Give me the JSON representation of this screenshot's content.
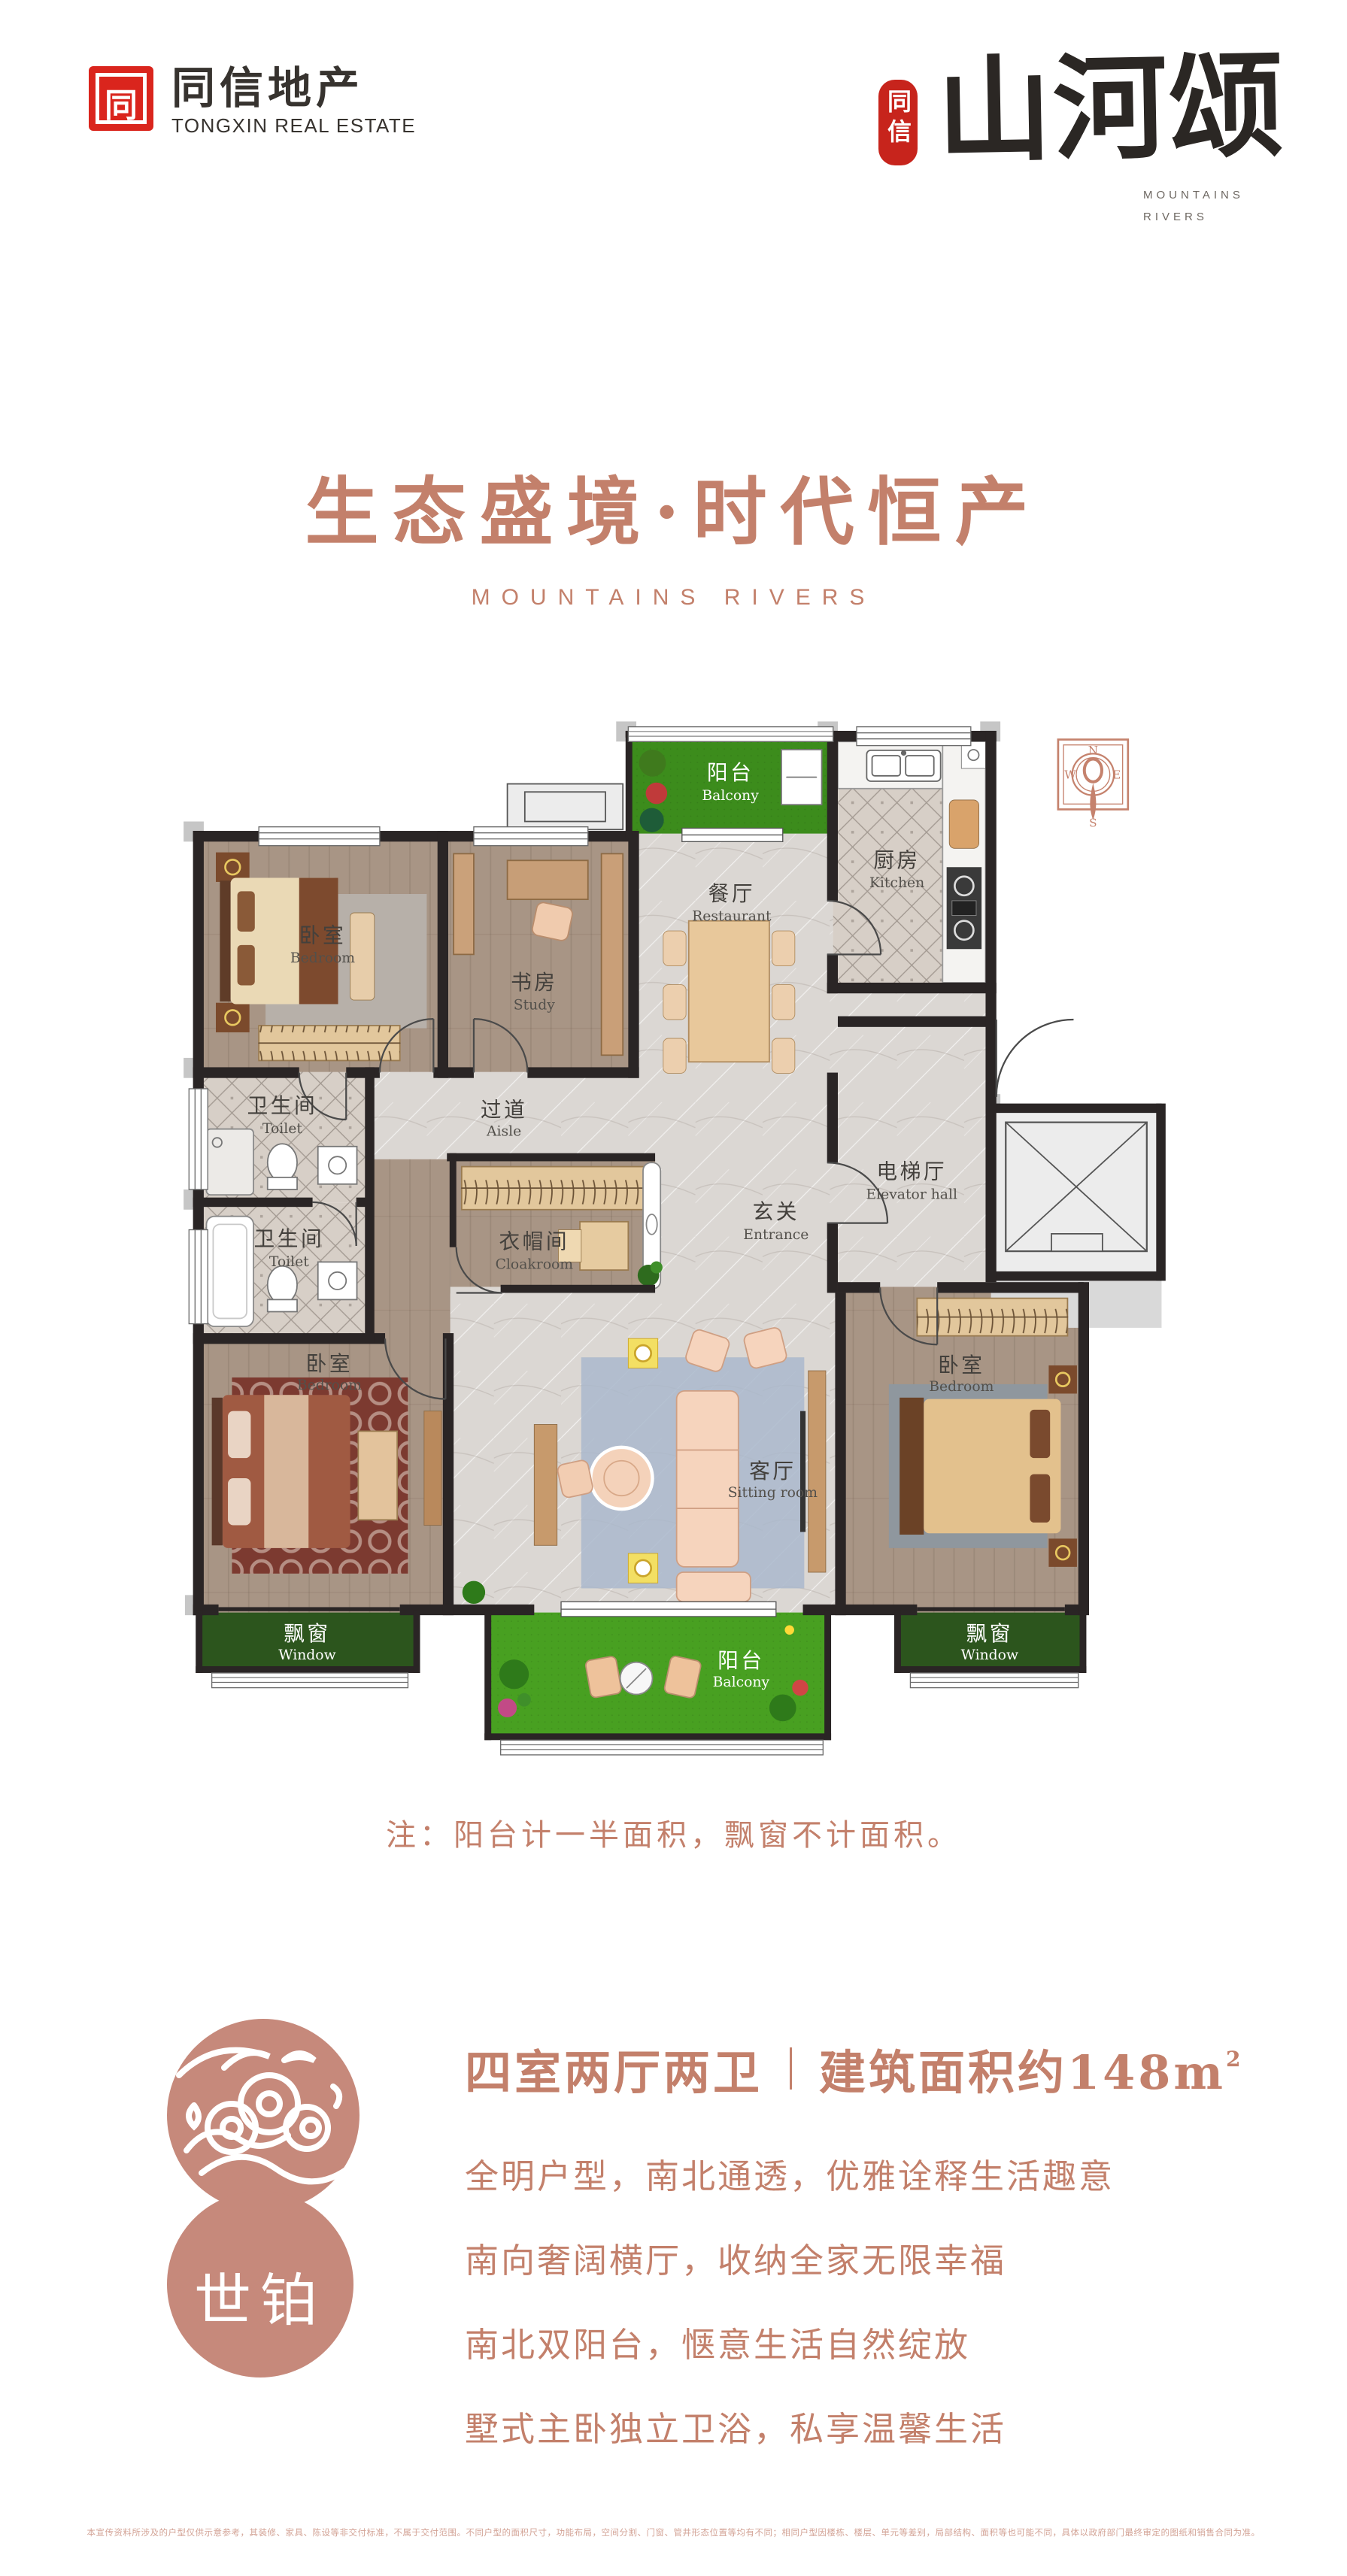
{
  "header": {
    "logo_glyph": "同",
    "logo_cn": "同信地产",
    "logo_en": "TONGXIN REAL ESTATE",
    "seal": "同信",
    "brand_calligraphy": "山河颂",
    "brand_sub1": "MOUNTAINS",
    "brand_sub2": "RIVERS"
  },
  "hero": {
    "title": "生态盛境·时代恒产",
    "subtitle": "MOUNTAINS RIVERS"
  },
  "plan": {
    "compass": {
      "n": "N",
      "e": "E",
      "s": "S",
      "w": "W"
    },
    "rooms": {
      "balcony_north": {
        "cn": "阳台",
        "en": "Balcony"
      },
      "kitchen": {
        "cn": "厨房",
        "en": "Kitchen"
      },
      "restaurant": {
        "cn": "餐厅",
        "en": "Restaurant"
      },
      "bedroom_nw": {
        "cn": "卧室",
        "en": "Bedroom"
      },
      "study": {
        "cn": "书房",
        "en": "Study"
      },
      "toilet_north": {
        "cn": "卫生间",
        "en": "Toilet"
      },
      "aisle": {
        "cn": "过道",
        "en": "Aisle"
      },
      "toilet_south": {
        "cn": "卫生间",
        "en": "Toilet"
      },
      "cloakroom": {
        "cn": "衣帽间",
        "en": "Cloakroom"
      },
      "entrance": {
        "cn": "玄关",
        "en": "Entrance"
      },
      "elevator_hall": {
        "cn": "电梯厅",
        "en": "Elevator hall"
      },
      "bedroom_sw": {
        "cn": "卧室",
        "en": "Bedroom"
      },
      "sitting_room": {
        "cn": "客厅",
        "en": "Sitting room"
      },
      "bedroom_se": {
        "cn": "卧室",
        "en": "Bedroom"
      },
      "window_sw": {
        "cn": "飘窗",
        "en": "Window"
      },
      "window_se": {
        "cn": "飘窗",
        "en": "Window"
      },
      "balcony_south": {
        "cn": "阳台",
        "en": "Balcony"
      }
    }
  },
  "note": "注：阳台计一半面积，飘窗不计面积。",
  "info": {
    "badge": "世铂",
    "layout": "四室两厅两卫",
    "area": "建筑面积约148m",
    "area_sup": "2",
    "features": [
      "全明户型，南北通透，优雅诠释生活趣意",
      "南向奢阔横厅，收纳全家无限幸福",
      "南北双阳台，惬意生活自然绽放",
      "墅式主卧独立卫浴，私享温馨生活"
    ]
  },
  "footer": {
    "disclaimer": "本宣传资料所涉及的户型仅供示意参考，其装修、家具、陈设等非交付标准，不属于交付范围。不同户型的面积尺寸，功能布局，空间分割、门窗、管井形态位置等均有不同；相同户型因楼栋、楼层、单元等差别，局部结构、面积等也可能不同，具体以政府部门最终审定的图纸和销售合同为准。"
  },
  "colors": {
    "accent": "#c3806b",
    "brand_red": "#da251d",
    "seal_red": "#c7241c",
    "wall": "#2a2525",
    "balcony_green": "#3f9120",
    "window_band_green": "#2c551d"
  }
}
